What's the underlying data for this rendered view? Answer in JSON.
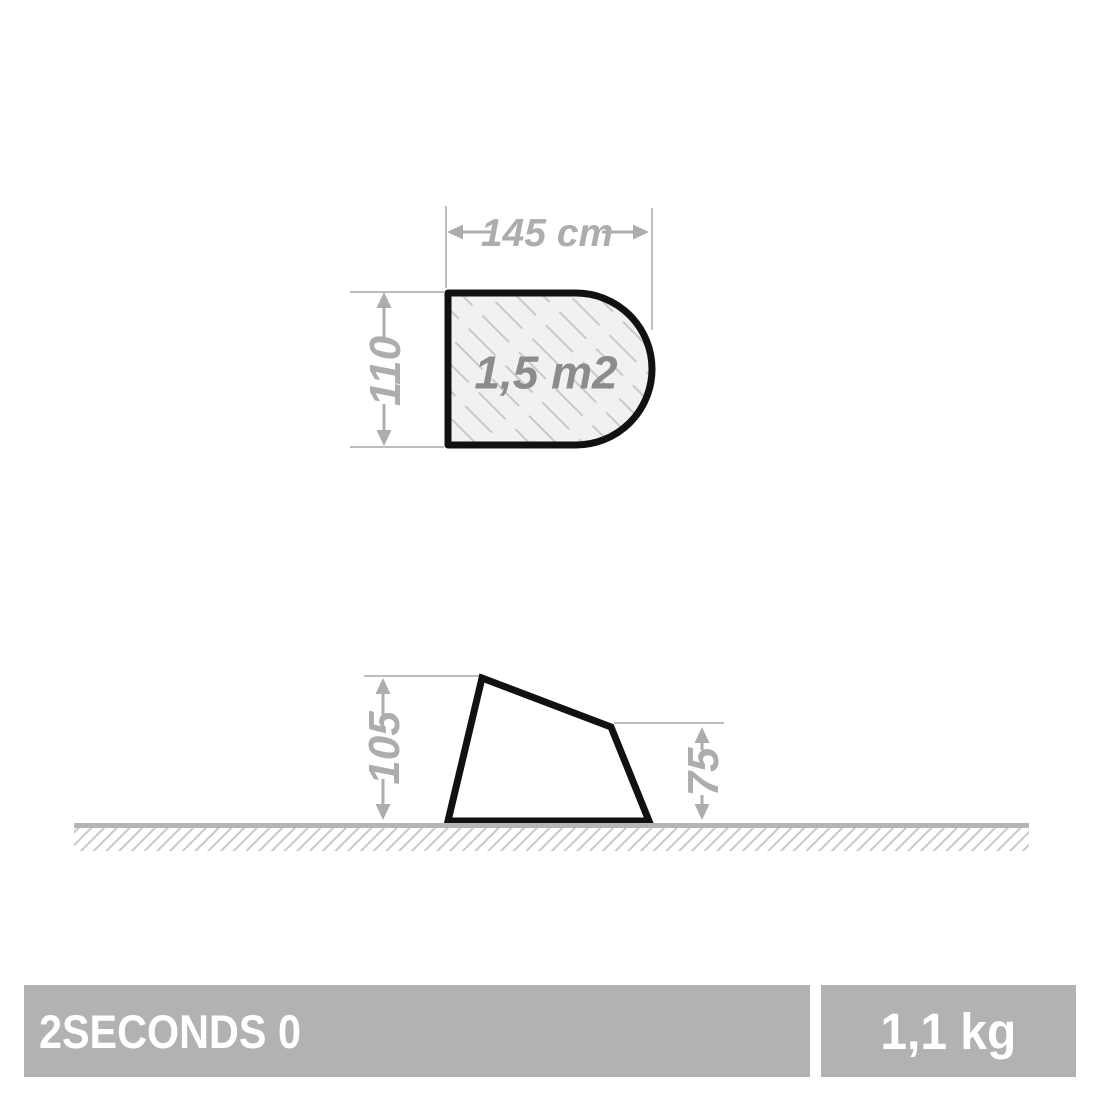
{
  "top_view": {
    "area_label": "1,5 m2",
    "width_dimension": {
      "label": "145 cm"
    },
    "height_dimension": {
      "label": "110"
    }
  },
  "side_view": {
    "left_height_dimension": {
      "label": "105"
    },
    "right_height_dimension": {
      "label": "75"
    }
  },
  "footer": {
    "product_name": "2SECONDS 0",
    "weight": "1,1 kg"
  },
  "colors": {
    "outline": "#111111",
    "dimension_gray": "#adadad",
    "area_text_gray": "#8c8c8c",
    "shape_fill": "#f1f1f1",
    "hatch_gray": "#c9c9c9",
    "ground_gray": "#b5b5b5",
    "bar_background": "#b2b2b2",
    "bar_text": "#ffffff"
  }
}
